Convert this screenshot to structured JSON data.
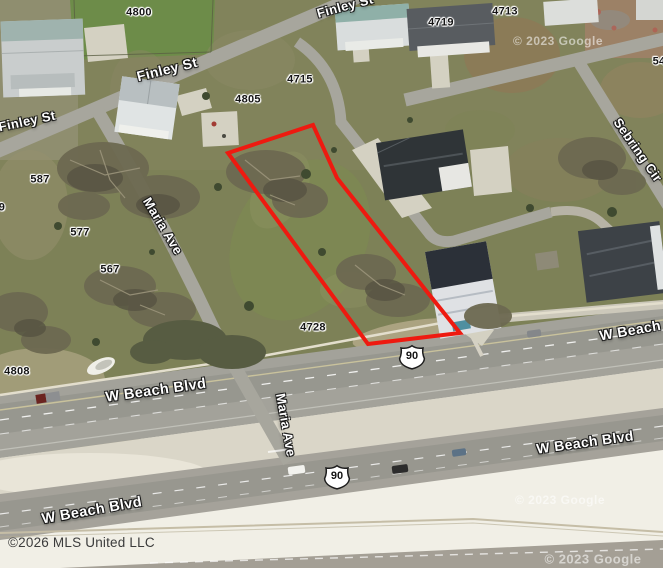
{
  "map": {
    "attribution": "©2026 MLS United LLC",
    "watermark": "© 2023 Google",
    "parcels": [
      "4800",
      "4719",
      "4713",
      "4715",
      "4805",
      "587",
      "9",
      "577",
      "567",
      "4728",
      "4808",
      "54"
    ],
    "streets": [
      "Finley St",
      "Finley St",
      "Finley St",
      "Maria Ave",
      "Maria Ave",
      "Sebring Cir",
      "W Beach Blvd",
      "W Beach Blvd",
      "W Beach Blvd",
      "W Beach Blvd"
    ],
    "shields": [
      "90",
      "90"
    ],
    "colors": {
      "boundary": "#ee1a10",
      "road": "#a7a69d",
      "grass": "#7d8157",
      "sand": "#e9e6da"
    }
  }
}
